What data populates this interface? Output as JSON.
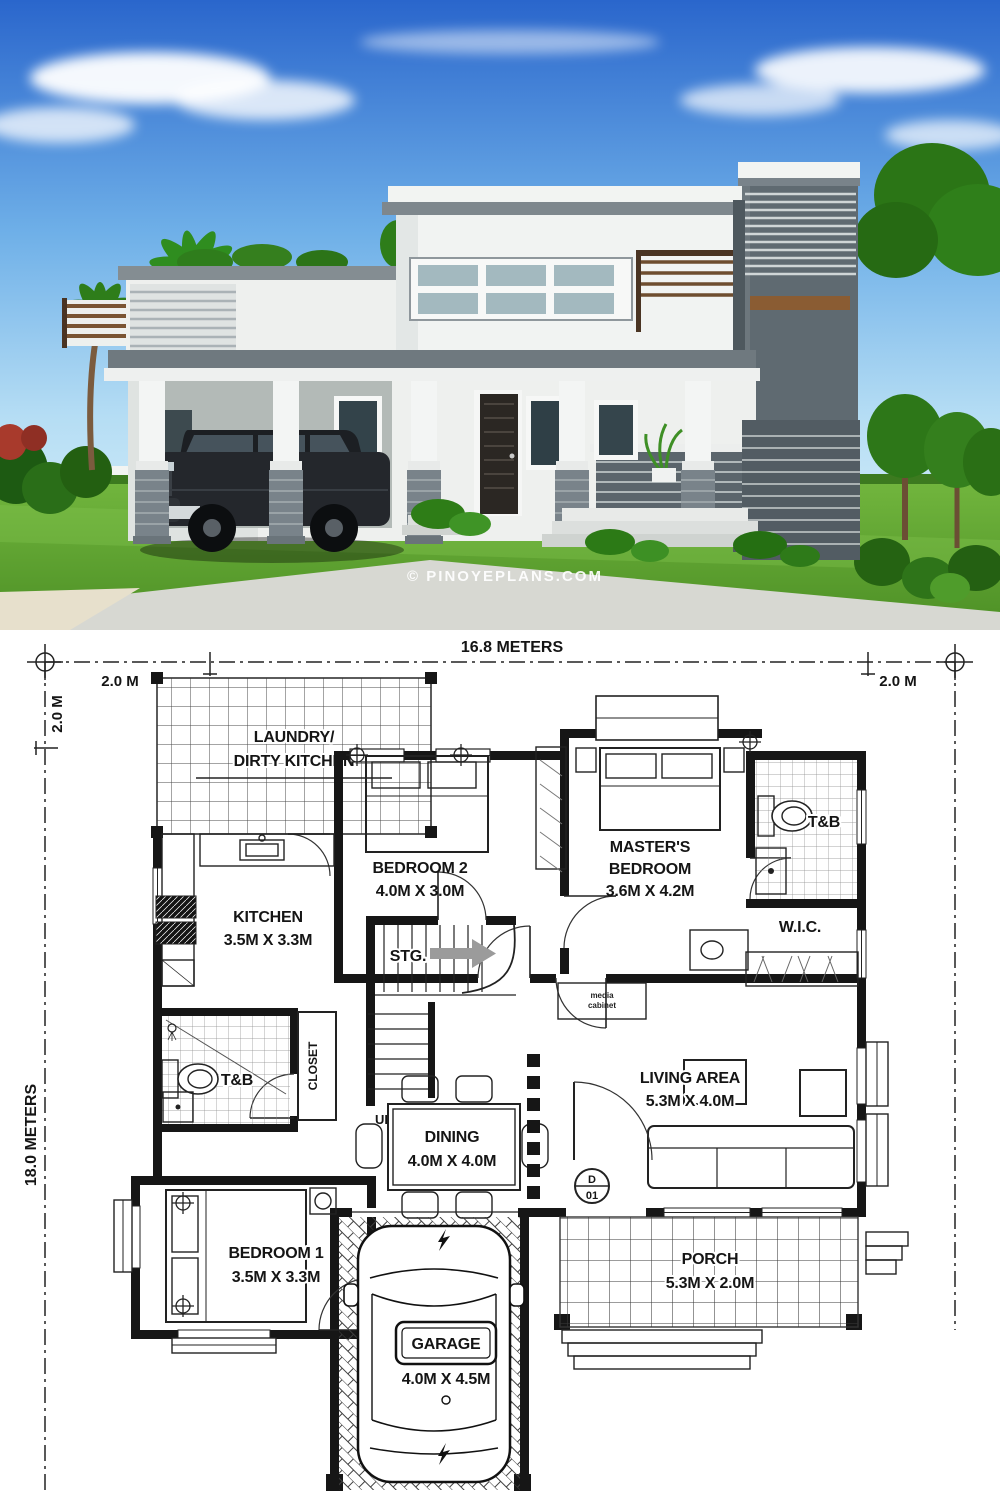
{
  "watermark": "© PINOYEPLANS.COM",
  "dimensions": {
    "overall_width": "16.8 METERS",
    "overall_depth": "18.0 METERS",
    "setback_left": "2.0 M",
    "setback_right": "2.0 M",
    "setback_front": "2.0 M"
  },
  "rooms": {
    "laundry": {
      "line1": "LAUNDRY/",
      "line2": "DIRTY KITCHEN"
    },
    "bedroom2": {
      "name": "BEDROOM 2",
      "size": "4.0M X 3.0M"
    },
    "master_bedroom": {
      "line1": "MASTER'S",
      "line2": "BEDROOM",
      "size": "3.6M X 4.2M"
    },
    "tb_upper": {
      "name": "T&B"
    },
    "kitchen": {
      "name": "KITCHEN",
      "size": "3.5M X 3.3M"
    },
    "wic": {
      "name": "W.I.C."
    },
    "storage": {
      "name": "STG."
    },
    "stairs_up": {
      "name": "UP"
    },
    "tb_lower": {
      "name": "T&B"
    },
    "closet": {
      "name": "CLOSET"
    },
    "living": {
      "name": "LIVING AREA",
      "size": "5.3M X 4.0M"
    },
    "dining": {
      "name": "DINING",
      "size": "4.0M X 4.0M"
    },
    "bedroom1": {
      "name": "BEDROOM 1",
      "size": "3.5M X 3.3M"
    },
    "porch": {
      "name": "PORCH",
      "size": "5.3M X 2.0M"
    },
    "garage": {
      "name": "GARAGE",
      "size": "4.0M X 4.5M"
    },
    "media_cabinet": {
      "line1": "media",
      "line2": "cabinet"
    }
  },
  "door_mark": {
    "letter": "D",
    "number": "01"
  },
  "colors": {
    "sky_top": "#2a66cc",
    "sky_bottom": "#cdeaf8",
    "grass": "#5fa730",
    "house_white": "#eef0ee",
    "accent_gray": "#6f797f",
    "stone_gray": "#5b656c",
    "wood": "#7a5433",
    "plan_line": "#161616"
  }
}
